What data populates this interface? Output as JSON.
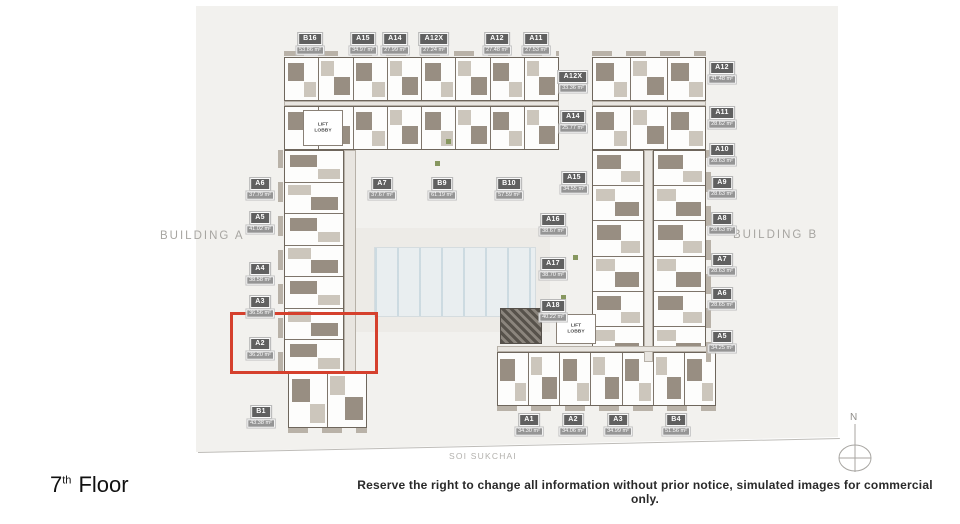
{
  "plan": {
    "building_a": "BUILDING A",
    "building_b": "BUILDING B",
    "lift_lobby": "LIFT LOBBY",
    "street": "SOI SUKCHAI",
    "compass_north": "N"
  },
  "highlight": {
    "unit": "A2",
    "color": "#d5402d"
  },
  "footer": {
    "floor_number": "7",
    "floor_suffix": "th",
    "floor_word": "Floor",
    "disclaimer": "Reserve the right to change all information without prior notice, simulated images for commercial only."
  },
  "units": [
    {
      "id": "b16",
      "name": "B16",
      "area": "53.86 m²"
    },
    {
      "id": "a15_top",
      "name": "A15",
      "area": "34.97 m²"
    },
    {
      "id": "a14_top",
      "name": "A14",
      "area": "27.99 m²"
    },
    {
      "id": "a12x_top",
      "name": "A12X",
      "area": "27.24 m²"
    },
    {
      "id": "a12_top",
      "name": "A12",
      "area": "27.48 m²"
    },
    {
      "id": "a11_top",
      "name": "A11",
      "area": "27.53 m²"
    },
    {
      "id": "a12_r",
      "name": "A12",
      "area": "41.48 m²"
    },
    {
      "id": "a11_r",
      "name": "A11",
      "area": "28.62 m²"
    },
    {
      "id": "a10_r",
      "name": "A10",
      "area": "28.63 m²"
    },
    {
      "id": "a9_r",
      "name": "A9",
      "area": "28.63 m²"
    },
    {
      "id": "a8_r",
      "name": "A8",
      "area": "28.63 m²"
    },
    {
      "id": "a7_r",
      "name": "A7",
      "area": "28.63 m²"
    },
    {
      "id": "a6_r",
      "name": "A6",
      "area": "28.65 m²"
    },
    {
      "id": "a5_r",
      "name": "A5",
      "area": "34.25 m²"
    },
    {
      "id": "a6_l",
      "name": "A6",
      "area": "37.79 m²"
    },
    {
      "id": "a5_l",
      "name": "A5",
      "area": "41.02 m²"
    },
    {
      "id": "a4_l",
      "name": "A4",
      "area": "38.58 m²"
    },
    {
      "id": "a3_l",
      "name": "A3",
      "area": "36.56 m²"
    },
    {
      "id": "a2_l",
      "name": "A2",
      "area": "36.20 m²"
    },
    {
      "id": "b1",
      "name": "B1",
      "area": "43.38 m²"
    },
    {
      "id": "a7_m",
      "name": "A7",
      "area": "37.67 m²"
    },
    {
      "id": "b9",
      "name": "B9",
      "area": "61.19 m²"
    },
    {
      "id": "b10",
      "name": "B10",
      "area": "57.59 m²"
    },
    {
      "id": "a12x_i",
      "name": "A12X",
      "area": "33.36 m²"
    },
    {
      "id": "a14_i",
      "name": "A14",
      "area": "25.77 m²"
    },
    {
      "id": "a15_i",
      "name": "A15",
      "area": "34.55 m²"
    },
    {
      "id": "a16",
      "name": "A16",
      "area": "38.67 m²"
    },
    {
      "id": "a17",
      "name": "A17",
      "area": "38.70 m²"
    },
    {
      "id": "a18",
      "name": "A18",
      "area": "40.22 m²"
    },
    {
      "id": "a1_b",
      "name": "A1",
      "area": "34.30 m²"
    },
    {
      "id": "a2_b",
      "name": "A2",
      "area": "34.06 m²"
    },
    {
      "id": "a3_b",
      "name": "A3",
      "area": "34.99 m²"
    },
    {
      "id": "b4",
      "name": "B4",
      "area": "51.56 m²"
    }
  ]
}
